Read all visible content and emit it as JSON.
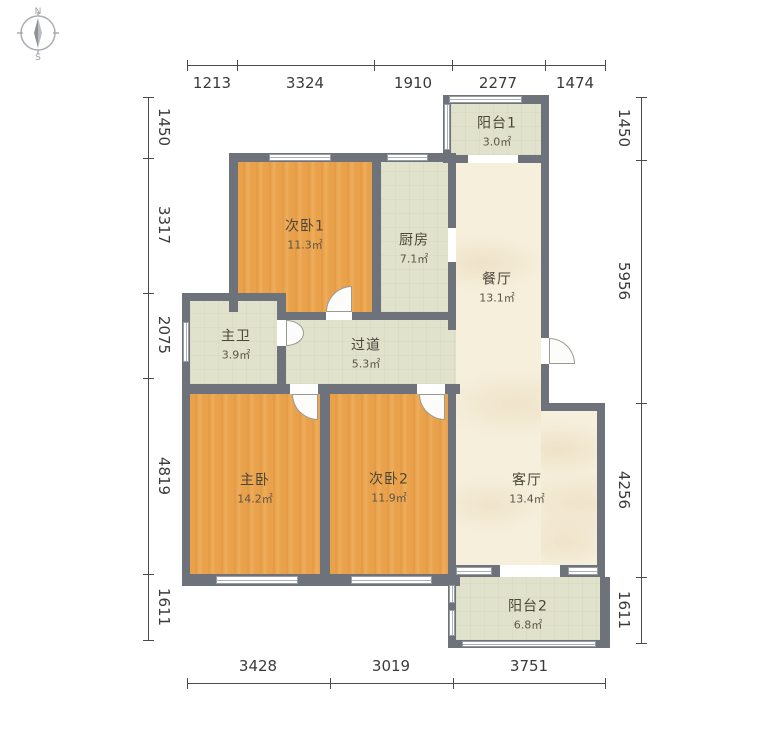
{
  "compass": {
    "north_label": "N",
    "south_label": "S"
  },
  "dimensions": {
    "top": [
      "1213",
      "3324",
      "1910",
      "2277",
      "1474"
    ],
    "bottom": [
      "3428",
      "3019",
      "3751"
    ],
    "left": [
      "1450",
      "3317",
      "2075",
      "4819",
      "1611"
    ],
    "right": [
      "1450",
      "5956",
      "4256",
      "1611"
    ]
  },
  "rooms": {
    "balcony1": {
      "name": "阳台1",
      "area": "3.0㎡"
    },
    "bedroom1": {
      "name": "次卧1",
      "area": "11.3㎡"
    },
    "kitchen": {
      "name": "厨房",
      "area": "7.1㎡"
    },
    "dining": {
      "name": "餐厅",
      "area": "13.1㎡"
    },
    "bath": {
      "name": "主卫",
      "area": "3.9㎡"
    },
    "corridor": {
      "name": "过道",
      "area": "5.3㎡"
    },
    "master": {
      "name": "主卧",
      "area": "14.2㎡"
    },
    "bedroom2": {
      "name": "次卧2",
      "area": "11.9㎡"
    },
    "living": {
      "name": "客厅",
      "area": "13.4㎡"
    },
    "balcony2": {
      "name": "阳台2",
      "area": "6.8㎡"
    }
  },
  "colors": {
    "wall": "#6d727b",
    "wood_floor": "#eaa14b",
    "tile_floor": "#e1e2cb",
    "marble_floor": "#f6efdc"
  }
}
